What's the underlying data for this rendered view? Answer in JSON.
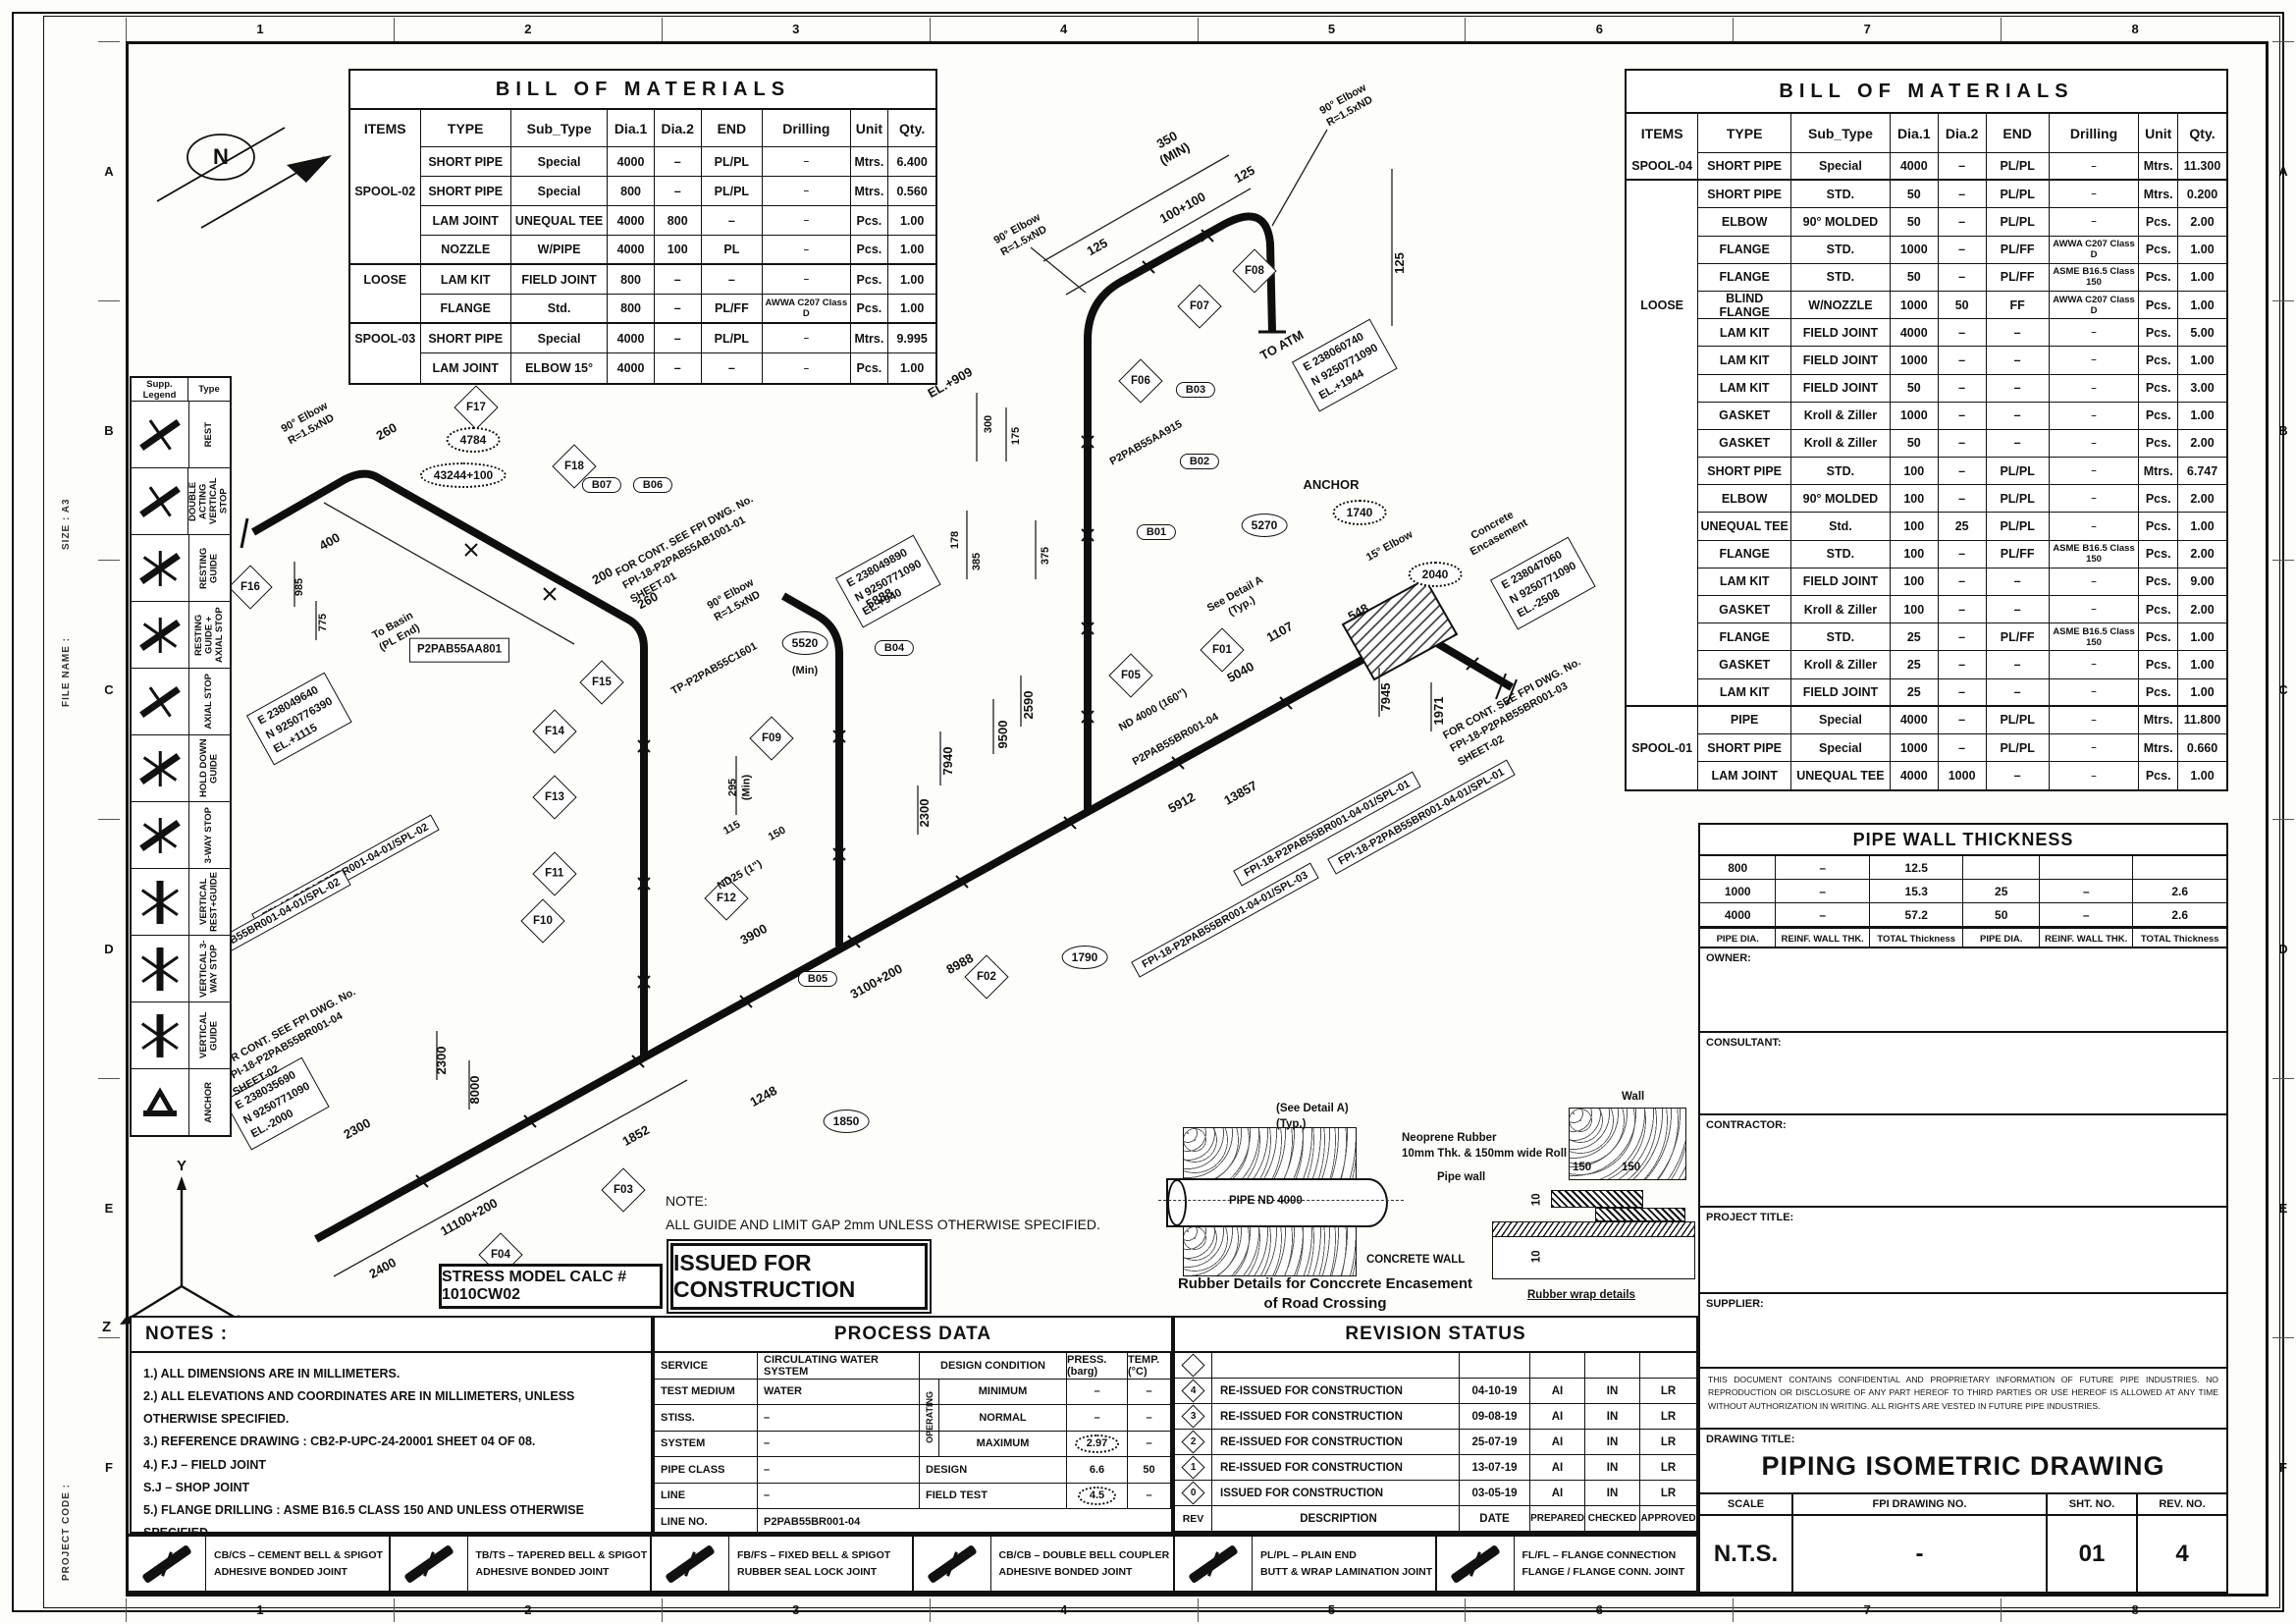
{
  "frame": {
    "cols": [
      "1",
      "2",
      "3",
      "4",
      "5",
      "6",
      "7",
      "8"
    ],
    "rows": [
      "A",
      "B",
      "C",
      "D",
      "E",
      "F"
    ],
    "size_label": "SIZE :  A3",
    "file_label": "FILE NAME :",
    "code_label": "PROJECT CODE :"
  },
  "left_bom": {
    "title": "BILL OF MATERIALS",
    "headers": [
      "ITEMS",
      "TYPE",
      "Sub_Type",
      "Dia.1",
      "Dia.2",
      "END",
      "Drilling",
      "Unit",
      "Qty."
    ],
    "rows": [
      {
        "item": "",
        "type": "SHORT PIPE",
        "sub": "Special",
        "d1": "4000",
        "d2": "–",
        "end": "PL/PL",
        "drill": "–",
        "unit": "Mtrs.",
        "qty": "6.400"
      },
      {
        "item": "SPOOL-02",
        "type": "SHORT PIPE",
        "sub": "Special",
        "d1": "800",
        "d2": "–",
        "end": "PL/PL",
        "drill": "–",
        "unit": "Mtrs.",
        "qty": "0.560"
      },
      {
        "item": "",
        "type": "LAM JOINT",
        "sub": "UNEQUAL TEE",
        "d1": "4000",
        "d2": "800",
        "end": "–",
        "drill": "–",
        "unit": "Pcs.",
        "qty": "1.00"
      },
      {
        "item": "",
        "type": "NOZZLE",
        "sub": "W/PIPE",
        "d1": "4000",
        "d2": "100",
        "end": "PL",
        "drill": "–",
        "unit": "Pcs.",
        "qty": "1.00",
        "cls": "grp"
      },
      {
        "item": "LOOSE",
        "type": "LAM KIT",
        "sub": "FIELD JOINT",
        "d1": "800",
        "d2": "–",
        "end": "–",
        "drill": "–",
        "unit": "Pcs.",
        "qty": "1.00"
      },
      {
        "item": "",
        "type": "FLANGE",
        "sub": "Std.",
        "d1": "800",
        "d2": "–",
        "end": "PL/FF",
        "drill": "AWWA C207 Class D",
        "unit": "Pcs.",
        "qty": "1.00",
        "cls": "grp"
      },
      {
        "item": "SPOOL-03",
        "type": "SHORT PIPE",
        "sub": "Special",
        "d1": "4000",
        "d2": "–",
        "end": "PL/PL",
        "drill": "–",
        "unit": "Mtrs.",
        "qty": "9.995"
      },
      {
        "item": "",
        "type": "LAM JOINT",
        "sub": "ELBOW 15°",
        "d1": "4000",
        "d2": "–",
        "end": "–",
        "drill": "–",
        "unit": "Pcs.",
        "qty": "1.00"
      }
    ]
  },
  "right_bom": {
    "title": "BILL OF MATERIALS",
    "headers": [
      "ITEMS",
      "TYPE",
      "Sub_Type",
      "Dia.1",
      "Dia.2",
      "END",
      "Drilling",
      "Unit",
      "Qty."
    ],
    "rows": [
      {
        "item": "SPOOL-04",
        "type": "SHORT PIPE",
        "sub": "Special",
        "d1": "4000",
        "d2": "–",
        "end": "PL/PL",
        "drill": "–",
        "unit": "Mtrs.",
        "qty": "11.300",
        "cls": "grp"
      },
      {
        "item": "",
        "type": "SHORT PIPE",
        "sub": "STD.",
        "d1": "50",
        "d2": "–",
        "end": "PL/PL",
        "drill": "–",
        "unit": "Mtrs.",
        "qty": "0.200"
      },
      {
        "item": "",
        "type": "ELBOW",
        "sub": "90° MOLDED",
        "d1": "50",
        "d2": "–",
        "end": "PL/PL",
        "drill": "–",
        "unit": "Pcs.",
        "qty": "2.00"
      },
      {
        "item": "",
        "type": "FLANGE",
        "sub": "STD.",
        "d1": "1000",
        "d2": "–",
        "end": "PL/FF",
        "drill": "AWWA C207 Class D",
        "unit": "Pcs.",
        "qty": "1.00"
      },
      {
        "item": "",
        "type": "FLANGE",
        "sub": "STD.",
        "d1": "50",
        "d2": "–",
        "end": "PL/FF",
        "drill": "ASME B16.5 Class 150",
        "unit": "Pcs.",
        "qty": "1.00"
      },
      {
        "item": "LOOSE",
        "type": "BLIND FLANGE",
        "sub": "W/NOZZLE",
        "d1": "1000",
        "d2": "50",
        "end": "FF",
        "drill": "AWWA C207 Class D",
        "unit": "Pcs.",
        "qty": "1.00"
      },
      {
        "item": "",
        "type": "LAM KIT",
        "sub": "FIELD JOINT",
        "d1": "4000",
        "d2": "–",
        "end": "–",
        "drill": "–",
        "unit": "Pcs.",
        "qty": "5.00"
      },
      {
        "item": "",
        "type": "LAM KIT",
        "sub": "FIELD JOINT",
        "d1": "1000",
        "d2": "–",
        "end": "–",
        "drill": "–",
        "unit": "Pcs.",
        "qty": "1.00"
      },
      {
        "item": "",
        "type": "LAM KIT",
        "sub": "FIELD JOINT",
        "d1": "50",
        "d2": "–",
        "end": "–",
        "drill": "–",
        "unit": "Pcs.",
        "qty": "3.00"
      },
      {
        "item": "",
        "type": "GASKET",
        "sub": "Kroll & Ziller",
        "d1": "1000",
        "d2": "–",
        "end": "–",
        "drill": "–",
        "unit": "Pcs.",
        "qty": "1.00"
      },
      {
        "item": "",
        "type": "GASKET",
        "sub": "Kroll & Ziller",
        "d1": "50",
        "d2": "–",
        "end": "–",
        "drill": "–",
        "unit": "Pcs.",
        "qty": "2.00"
      },
      {
        "item": "",
        "type": "SHORT PIPE",
        "sub": "STD.",
        "d1": "100",
        "d2": "–",
        "end": "PL/PL",
        "drill": "–",
        "unit": "Mtrs.",
        "qty": "6.747"
      },
      {
        "item": "",
        "type": "ELBOW",
        "sub": "90° MOLDED",
        "d1": "100",
        "d2": "–",
        "end": "PL/PL",
        "drill": "–",
        "unit": "Pcs.",
        "qty": "2.00"
      },
      {
        "item": "",
        "type": "UNEQUAL TEE",
        "sub": "Std.",
        "d1": "100",
        "d2": "25",
        "end": "PL/PL",
        "drill": "–",
        "unit": "Pcs.",
        "qty": "1.00"
      },
      {
        "item": "",
        "type": "FLANGE",
        "sub": "STD.",
        "d1": "100",
        "d2": "–",
        "end": "PL/FF",
        "drill": "ASME B16.5 Class 150",
        "unit": "Pcs.",
        "qty": "2.00"
      },
      {
        "item": "",
        "type": "LAM KIT",
        "sub": "FIELD JOINT",
        "d1": "100",
        "d2": "–",
        "end": "–",
        "drill": "–",
        "unit": "Pcs.",
        "qty": "9.00"
      },
      {
        "item": "",
        "type": "GASKET",
        "sub": "Kroll & Ziller",
        "d1": "100",
        "d2": "–",
        "end": "–",
        "drill": "–",
        "unit": "Pcs.",
        "qty": "2.00"
      },
      {
        "item": "",
        "type": "FLANGE",
        "sub": "STD.",
        "d1": "25",
        "d2": "–",
        "end": "PL/FF",
        "drill": "ASME B16.5 Class 150",
        "unit": "Pcs.",
        "qty": "1.00"
      },
      {
        "item": "",
        "type": "GASKET",
        "sub": "Kroll & Ziller",
        "d1": "25",
        "d2": "–",
        "end": "–",
        "drill": "–",
        "unit": "Pcs.",
        "qty": "1.00"
      },
      {
        "item": "",
        "type": "LAM KIT",
        "sub": "FIELD JOINT",
        "d1": "25",
        "d2": "–",
        "end": "–",
        "drill": "–",
        "unit": "Pcs.",
        "qty": "1.00",
        "cls": "grp"
      },
      {
        "item": "",
        "type": "PIPE",
        "sub": "Special",
        "d1": "4000",
        "d2": "–",
        "end": "PL/PL",
        "drill": "–",
        "unit": "Mtrs.",
        "qty": "11.800"
      },
      {
        "item": "SPOOL-01",
        "type": "SHORT PIPE",
        "sub": "Special",
        "d1": "1000",
        "d2": "–",
        "end": "PL/PL",
        "drill": "–",
        "unit": "Mtrs.",
        "qty": "0.660"
      },
      {
        "item": "",
        "type": "LAM JOINT",
        "sub": "UNEQUAL TEE",
        "d1": "4000",
        "d2": "1000",
        "end": "–",
        "drill": "–",
        "unit": "Pcs.",
        "qty": "1.00"
      }
    ]
  },
  "supports": {
    "legend_header": "Supp. Legend",
    "type_header": "Type",
    "items": [
      {
        "type": "REST",
        "cls": "s1"
      },
      {
        "type": "DOUBLE ACTING VERTICAL STOP",
        "cls": "s1"
      },
      {
        "type": "RESTING GUIDE",
        "cls": "s2"
      },
      {
        "type": "RESTING GUIDE + AXIAL STOP",
        "cls": "s2"
      },
      {
        "type": "AXIAL STOP",
        "cls": "s1"
      },
      {
        "type": "HOLD DOWN GUIDE",
        "cls": "s2"
      },
      {
        "type": "3-WAY STOP",
        "cls": "s2"
      },
      {
        "type": "VERTICAL REST+GUIDE",
        "cls": "s3"
      },
      {
        "type": "VERTICAL 3-WAY STOP",
        "cls": "s3"
      },
      {
        "type": "VERTICAL GUIDE",
        "cls": "s3"
      },
      {
        "type": "ANCHOR",
        "cls": "s4"
      }
    ]
  },
  "wall_thickness": {
    "title": "PIPE WALL THICKNESS",
    "rows": [
      {
        "0": "800",
        "1": "–",
        "2": "12.5",
        "3": "",
        "4": "",
        "5": ""
      },
      {
        "0": "1000",
        "1": "–",
        "2": "15.3",
        "3": "25",
        "4": "–",
        "5": "2.6"
      },
      {
        "0": "4000",
        "1": "–",
        "2": "57.2",
        "3": "50",
        "4": "–",
        "5": "2.6"
      }
    ],
    "footer": [
      "PIPE DIA.",
      "REINF. WALL THK.",
      "TOTAL Thickness",
      "PIPE DIA.",
      "REINF. WALL THK.",
      "TOTAL Thickness"
    ]
  },
  "title_block": {
    "owner_label": "OWNER:",
    "consultant_label": "CONSULTANT:",
    "contractor_label": "CONTRACTOR:",
    "project_title_label": "PROJECT TITLE:",
    "supplier_label": "SUPPLIER:",
    "confidential": "THIS DOCUMENT CONTAINS CONFIDENTIAL AND PROPRIETARY INFORMATION OF FUTURE PIPE INDUSTRIES. NO REPRODUCTION OR DISCLOSURE OF ANY PART HEREOF TO THIRD PARTIES OR USE HEREOF IS ALLOWED AT ANY TIME WITHOUT AUTHORIZATION IN WRITING. ALL RIGHTS ARE VESTED IN FUTURE PIPE INDUSTRIES.",
    "drawing_title_label": "DRAWING TITLE:",
    "drawing_title": "PIPING ISOMETRIC DRAWING",
    "scale_label": "SCALE",
    "scale_value": "N.T.S.",
    "drawing_no_label": "FPI DRAWING NO.",
    "drawing_no_value": "-",
    "sheet_label": "SHT. NO.",
    "sheet_value": "01",
    "rev_label": "REV. NO.",
    "rev_value": "4"
  },
  "notes": {
    "title": "NOTES :",
    "lines": [
      "1.) ALL DIMENSIONS ARE IN MILLIMETERS.",
      "2.) ALL ELEVATIONS AND COORDINATES ARE IN MILLIMETERS, UNLESS OTHERWISE SPECIFIED.",
      "3.) REFERENCE DRAWING :  CB2-P-UPC-24-20001 SHEET 04 OF 08.",
      "4.) F.J – FIELD JOINT",
      "      S.J – SHOP JOINT",
      "5.) FLANGE DRILLING : ASME B16.5 CLASS 150 AND UNLESS OTHERWISE SPECIFIED."
    ]
  },
  "process_data": {
    "title": "PROCESS DATA",
    "left_rows": [
      [
        "SERVICE",
        "CIRCULATING WATER SYSTEM"
      ],
      [
        "TEST MEDIUM",
        "WATER"
      ],
      [
        "STISS.",
        "–"
      ],
      [
        "SYSTEM",
        "–"
      ],
      [
        "PIPE CLASS",
        "–"
      ],
      [
        "LINE",
        "–"
      ]
    ],
    "line_no_label": "LINE NO.",
    "line_no_value": "P2PAB55BR001-04",
    "cond_header": [
      "DESIGN CONDITION",
      "PRESS. (barg)",
      "TEMP. (°C)"
    ],
    "operating_label": "OPERATING",
    "cond_rows": [
      [
        "MINIMUM",
        "–",
        "–"
      ],
      [
        "NORMAL",
        "–",
        "–"
      ],
      [
        "MAXIMUM",
        "2.97",
        "–"
      ],
      [
        "DESIGN",
        "6.6",
        "50"
      ],
      [
        "FIELD TEST",
        "4.5",
        "–"
      ]
    ]
  },
  "revision_status": {
    "title": "REVISION STATUS",
    "rows": [
      {
        "rev": "",
        "description": "",
        "date": "",
        "prepared": "",
        "checked": "",
        "approved": ""
      },
      {
        "rev": "4",
        "description": "RE-ISSUED FOR CONSTRUCTION",
        "date": "04-10-19",
        "prepared": "AI",
        "checked": "IN",
        "approved": "LR"
      },
      {
        "rev": "3",
        "description": "RE-ISSUED FOR CONSTRUCTION",
        "date": "09-08-19",
        "prepared": "AI",
        "checked": "IN",
        "approved": "LR"
      },
      {
        "rev": "2",
        "description": "RE-ISSUED FOR CONSTRUCTION",
        "date": "25-07-19",
        "prepared": "AI",
        "checked": "IN",
        "approved": "LR"
      },
      {
        "rev": "1",
        "description": "RE-ISSUED FOR CONSTRUCTION",
        "date": "13-07-19",
        "prepared": "AI",
        "checked": "IN",
        "approved": "LR"
      },
      {
        "rev": "0",
        "description": "ISSUED FOR CONSTRUCTION",
        "date": "03-05-19",
        "prepared": "AI",
        "checked": "IN",
        "approved": "LR"
      }
    ],
    "footer": [
      "REV",
      "DESCRIPTION",
      "DATE",
      "PREPARED",
      "CHECKED",
      "APPROVED"
    ]
  },
  "joint_legend": {
    "items": [
      {
        "code": "CB/CS – CEMENT BELL & SPIGOT",
        "desc": "ADHESIVE BONDED JOINT"
      },
      {
        "code": "TB/TS – TAPERED BELL & SPIGOT",
        "desc": "ADHESIVE BONDED JOINT"
      },
      {
        "code": "FB/FS – FIXED BELL & SPIGOT",
        "desc": "RUBBER SEAL LOCK JOINT"
      },
      {
        "code": "CB/CB – DOUBLE BELL COUPLER",
        "desc": "ADHESIVE BONDED JOINT"
      },
      {
        "code": "PL/PL – PLAIN END",
        "desc": "BUTT & WRAP LAMINATION JOINT"
      },
      {
        "code": "FL/FL – FLANGE CONNECTION",
        "desc": "FLANGE / FLANGE CONN. JOINT"
      }
    ]
  },
  "iso": {
    "north": "N",
    "axis": {
      "x": "X",
      "y": "Y",
      "z": "Z"
    },
    "flags": [
      "F01",
      "F02",
      "F03",
      "F04",
      "F05",
      "F06",
      "F07",
      "F08",
      "F09",
      "F10",
      "F11",
      "F12",
      "F13",
      "F14",
      "F15",
      "F16",
      "F17",
      "F18"
    ],
    "bubbles": [
      "B01",
      "B02",
      "B03",
      "B04",
      "B05",
      "B06",
      "B07"
    ],
    "circles": [
      "5270",
      "5520",
      "1790",
      "1850"
    ],
    "clouds": [
      "4784",
      "43244+100",
      "1740",
      "2040"
    ],
    "coord_boxes": [
      "E  238060740\nN  9250771090\nEL.+1944",
      "E  238049890\nN  9250771090\nEL.+940",
      "E  238049640\nN  9250776390\nEL.+1115",
      "E  238035690\nN  9250771090\nEL.-2000",
      "E  238047060\nN  9250771090\nEL.-2508"
    ],
    "callouts": [
      "FPI-18-P2PAB55BR001-04-01/SPL-02",
      "FPI-18-P2PAB55BR001-04-01/SPL-02",
      "FPI-18-P2PAB55BR001-04-01/SPL-03",
      "FPI-18-P2PAB55BR001-04-01/SPL-01",
      "FPI-18-P2PAB55BR001-04-01/SPL-01"
    ],
    "cont_notes": [
      "FOR CONT. SEE FPI DWG. No.\nFPI-18-P2PAB55AB1001-01\nSHEET-01",
      "FOR CONT. SEE FPI DWG. No.\nFPI-18-P2PAB55BR001-04\nSHEET-02",
      "FOR CONT. SEE FPI DWG. No.\nFPI-18-P2PAB55BR001-03\nSHEET-02"
    ],
    "tag_box": "P2PAB55AA801",
    "texts": [
      "350\n(MIN)",
      "125",
      "100+100",
      "125",
      "90° Elbow\nR=1.5xND",
      "125",
      "TO ATM",
      "90° Elbow\nR=1.5xND",
      "EL.+909",
      "300",
      "175",
      "385",
      "178",
      "375",
      "P2PAB55AA915",
      "ANCHOR",
      "90° Elbow\nR=1.5xND",
      "(Min)",
      "TP-P2PAB55C1601",
      "90° Elbow\nR=1.5xND",
      "260",
      "400",
      "985",
      "775",
      "To Basin\n(PL End)",
      "200",
      "260",
      "295\n(Min)",
      "115",
      "150",
      "ND25 (1\")",
      "3900",
      "2300",
      "8000",
      "2300",
      "11100+200",
      "2400",
      "1852",
      "1248",
      "3100+200",
      "8988",
      "5888",
      "9500",
      "2590",
      "7940",
      "2300",
      "5912",
      "13857",
      "See Detail A\n(Typ.)",
      "5040",
      "ND 4000 (160\")",
      "P2PAB55BR001-04",
      "1107",
      "548",
      "15° Elbow",
      "Concrete\nEncasement",
      "7945",
      "1971"
    ],
    "note": "NOTE:\nALL GUIDE AND LIMIT GAP 2mm UNLESS OTHERWISE SPECIFIED.",
    "stamp_issued": "ISSUED FOR CONSTRUCTION",
    "stamp_stress": "STRESS MODEL CALC # 1010CW02",
    "detail": {
      "see_detail": "(See Detail A)\n(Typ.)",
      "pipe_nd": "PIPE ND 4000",
      "concrete_wall": "CONCRETE WALL",
      "caption": "Rubber Details for Conccrete Encasement\nof Road Crossing",
      "neoprene": "Neoprene Rubber\n10mm Thk. & 150mm wide Roll",
      "pipe_wall": "Pipe wall",
      "wall": "Wall",
      "d150a": "150",
      "d150b": "150",
      "d10a": "10",
      "d10b": "10",
      "wrap": "Rubber wrap details",
      "detail_a": "DETAIL 'A'"
    }
  }
}
